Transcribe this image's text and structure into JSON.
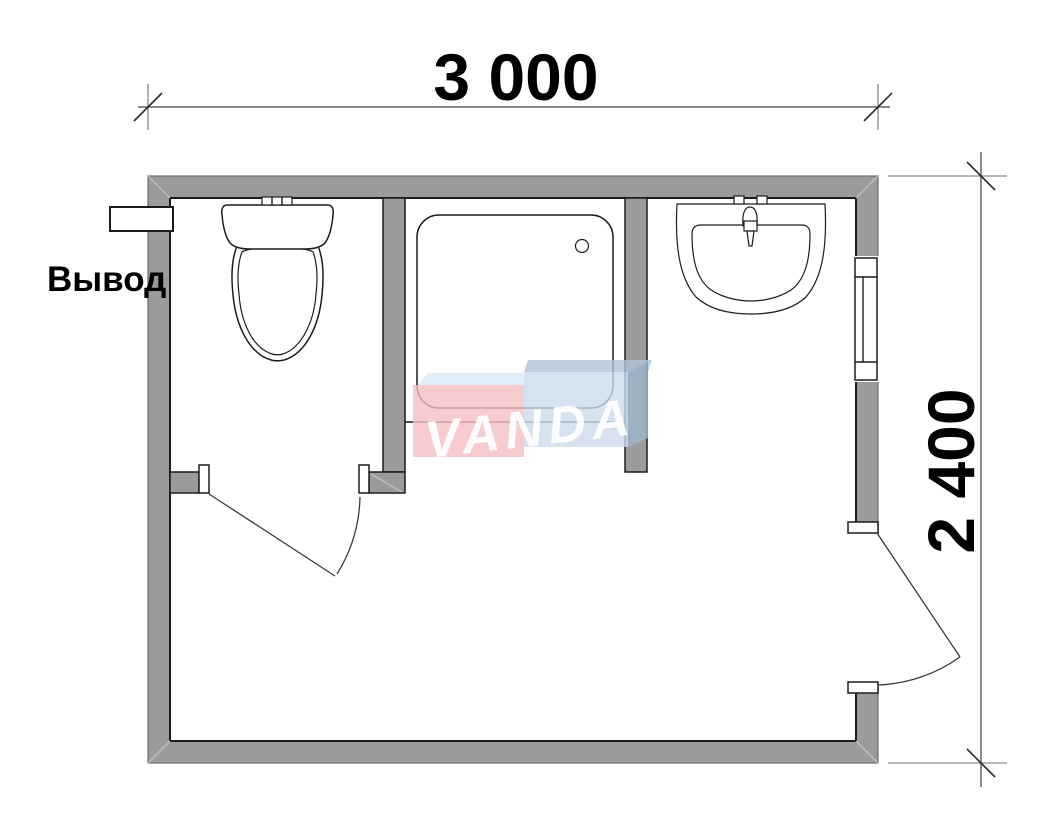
{
  "plan": {
    "dimension_width_label": "3 000",
    "dimension_height_label": "2 400",
    "outlet_label": "Вывод",
    "watermark_text": "VANDA"
  },
  "colors": {
    "wall": "#9b9b9b",
    "line": "#1c1c1c",
    "dim_line": "#8a8a8a",
    "dim_ext": "#6f6f6f",
    "tick": "#2a2a2a",
    "miter": "#c6c6c6",
    "logo_pink": "#f4c0c4",
    "logo_blue": "#ccdcec",
    "logo_bevel_light": "#d8eaf7",
    "logo_bevel_dark": "#b2c5d9",
    "logo_side": "#9fb6cd",
    "logo_text": "#ffffff"
  }
}
